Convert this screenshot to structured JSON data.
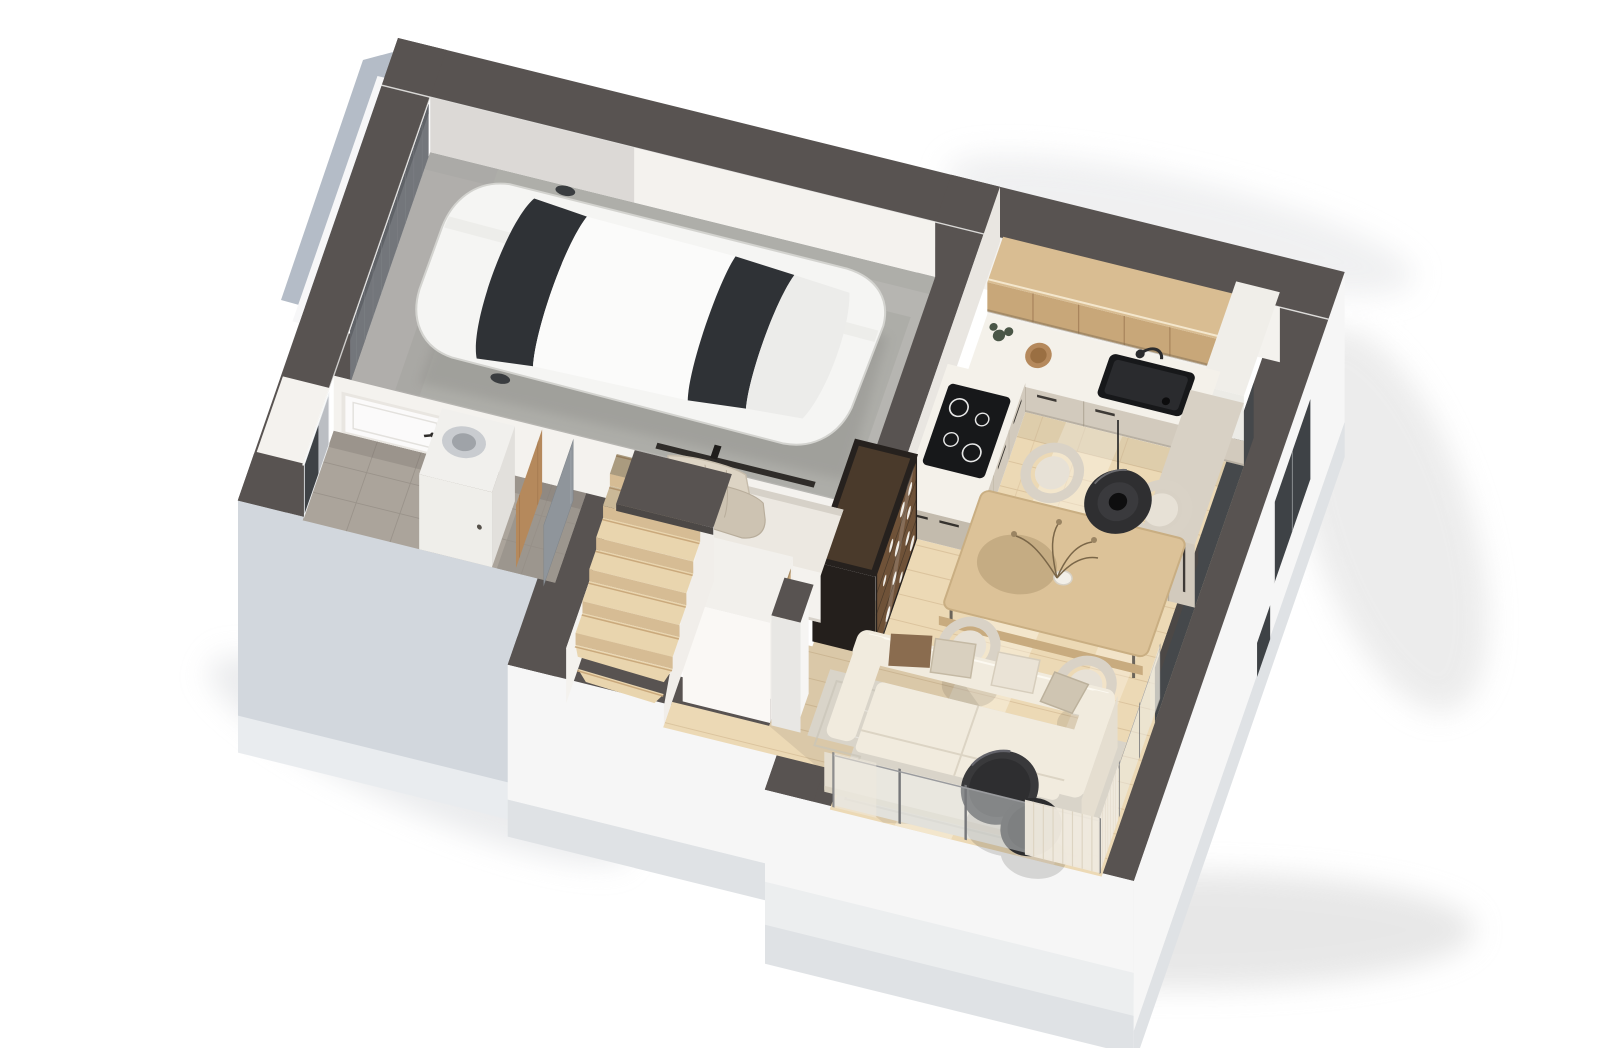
{
  "title": "3D axonometric floor plan — ground floor with garage, kitchen, dining and living room",
  "scene": {
    "projection": "axonometric cutaway dollhouse view",
    "background": "#ffffff"
  },
  "colors": {
    "bg": "#ffffff",
    "wallTop": "#585351",
    "wallTopDark": "#4c4846",
    "extGray": "#d2d7dd",
    "extGrayLight": "#e9ecef",
    "extWhite": "#f6f6f6",
    "extWhiteDim": "#eceeef",
    "extBase": "#dfe2e5",
    "faceCream": "#f4f2ee",
    "faceCreamDim": "#e9e6e1",
    "floorWood": "#ecd9b5",
    "plankLine": "#d9c09a",
    "floorTile": "#aba49b",
    "floorTileDark": "#9c968e",
    "tileLine": "#968f87",
    "garageFloor": "#b6b5b1",
    "stairWood": "#e9d5ae",
    "stairRiser": "#d6bc94",
    "stringer": "#f1eeea",
    "shelfWhite": "#f2f0ec",
    "cubbyWood": "#c8a87c",
    "cabinetWood": "#c8a779",
    "cabinetWoodTop": "#d9bd92",
    "counterTop": "#f4f1ea",
    "cabinetBeige": "#d2cabd",
    "cabinetBeigeDark": "#c3bbad",
    "applianceBlack": "#17181a",
    "tableWood": "#dcc298",
    "tableEdge": "#c8ab7f",
    "chairFabric": "#e7e1d6",
    "sofaFabric": "#f1ebde",
    "sofaShade": "#e5ded0",
    "pillowBrown": "#8a6c4f",
    "pillowTan": "#d9d0bf",
    "rug": "#d9d4c9",
    "roundTable": "#39393b",
    "curtain": "#efe9dd",
    "glassTint": "#eef1f1",
    "frameGray": "#76777a",
    "windowDark": "#3e4246",
    "innerDark": "#45484b",
    "doorWhite": "#fbfafa",
    "doorWood": "#b5895c",
    "panelGray": "#8f959b",
    "garageDoor": "#73767b",
    "garageDoorOut": "#b4bcc7",
    "displayWood": "#6f5238",
    "displayFrame": "#26211e",
    "carBody": "#f5f5f3",
    "carGlass": "#2f3236",
    "ventWhite": "#f1f0ed",
    "metalGray": "#c9ccd0",
    "clothes": "#ddd4c4",
    "shadowSoft": "#d4d4d4"
  },
  "rooms": [
    {
      "id": "garage",
      "label": "Garage"
    },
    {
      "id": "entry-hall",
      "label": "Entry hall"
    },
    {
      "id": "technical-room",
      "label": "Technical room"
    },
    {
      "id": "bathroom",
      "label": "Bathroom"
    },
    {
      "id": "kitchen",
      "label": "Kitchen"
    },
    {
      "id": "dining-area",
      "label": "Dining area"
    },
    {
      "id": "living-room",
      "label": "Living room"
    },
    {
      "id": "staircase",
      "label": "Winder staircase"
    }
  ],
  "furniture": {
    "garage": [
      "white car"
    ],
    "kitchen": [
      "oak upper cabinets",
      "white countertop with black sink and faucet",
      "induction cooktop",
      "beige drawer units",
      "tall beige cabinet",
      "white corner column",
      "wooden bowl",
      "plant"
    ],
    "dining-area": [
      "wooden dining table",
      "four upholstered chairs",
      "black pendant lamp",
      "vase with dried flowers"
    ],
    "living-room": [
      "cream three-seat sofa with pillows",
      "gray area rug",
      "two round black coffee tables",
      "glazed sliding wall with sheer curtains",
      "freestanding white pillar"
    ],
    "entry-hall": [
      "white entry door",
      "window with curtain",
      "built-in wardrobe",
      "coat rack with clothes",
      "glass display cabinet with tableware"
    ],
    "technical-room": [
      "ventilation unit with flexible duct",
      "wooden interior door"
    ],
    "bathroom": [
      "gray door panel",
      "gray tiled floor"
    ],
    "staircase": [
      "wooden winder stairs",
      "white shelving unit with oak cubbies",
      "upper-flight cut band"
    ]
  }
}
